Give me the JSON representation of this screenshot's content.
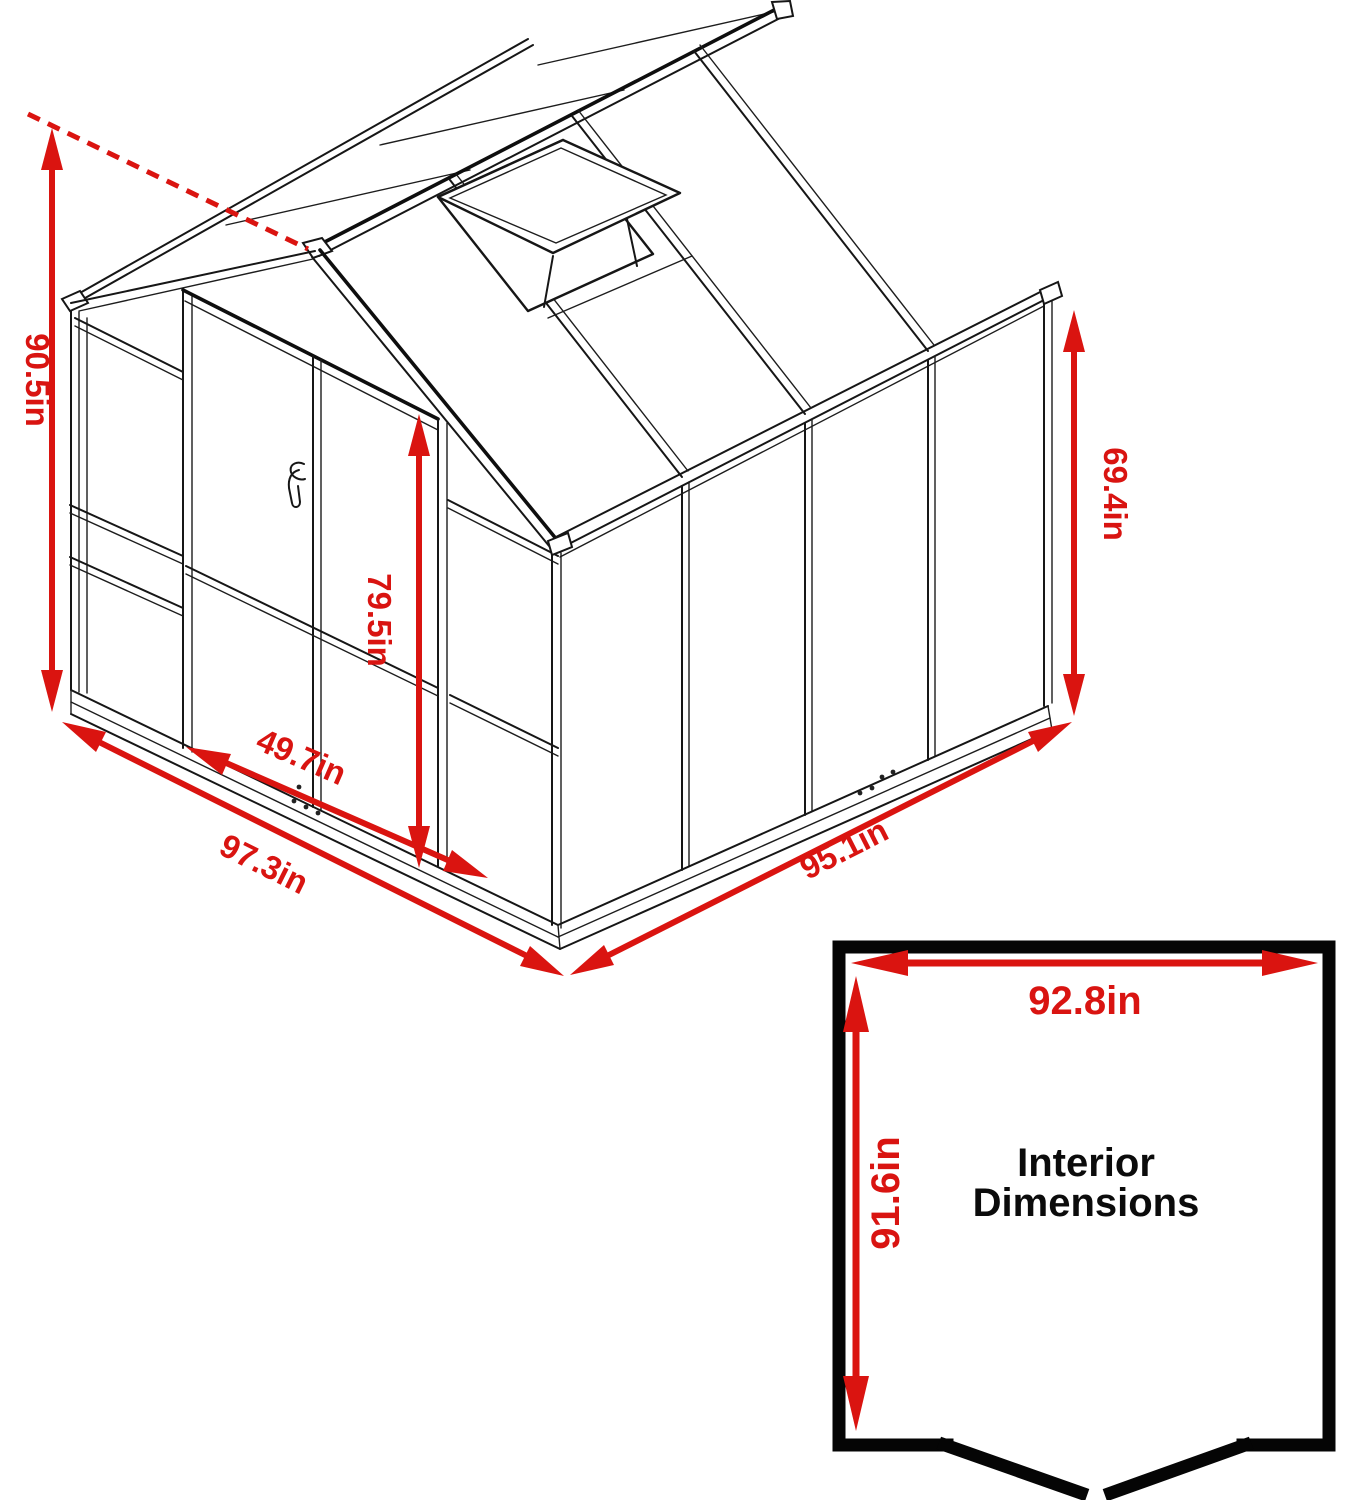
{
  "colors": {
    "annotation_red": "#da1410",
    "line_black": "#161616",
    "caption_black": "#0b0b0b",
    "background": "#ffffff"
  },
  "greenhouse_dimensions": {
    "overall_height": "90.5in",
    "wall_height": "69.4in",
    "door_height": "79.5in",
    "door_width": "49.7in",
    "base_width": "97.3in",
    "base_depth": "95.1in"
  },
  "interior_box": {
    "width": "92.8in",
    "depth": "91.6in",
    "caption_line1": "Interior",
    "caption_line2": "Dimensions"
  }
}
